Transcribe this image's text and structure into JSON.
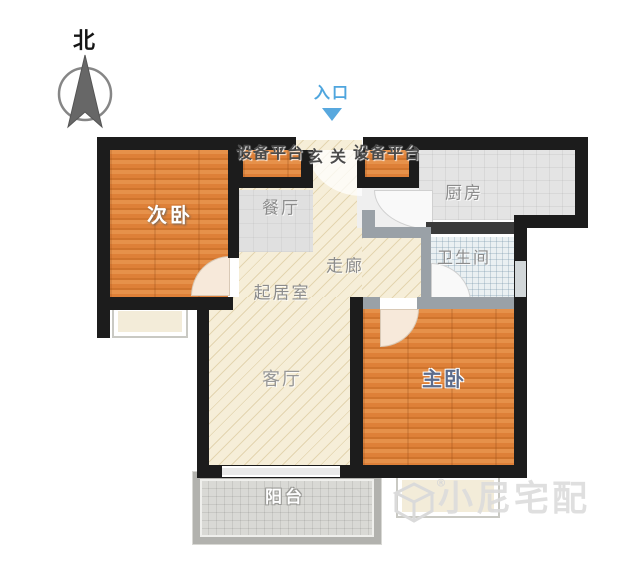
{
  "compass": {
    "north_label": "北"
  },
  "entrance": {
    "label": "入口"
  },
  "rooms": {
    "equipment_platform_left": "设备平台",
    "entry_hall": "玄关",
    "equipment_platform_right": "设备平台",
    "secondary_bedroom": "次卧",
    "dining_room": "餐厅",
    "kitchen": "厨房",
    "corridor": "走廊",
    "bathroom": "卫生间",
    "living_area": "起居室",
    "living_room": "客厅",
    "master_bedroom": "主卧",
    "balcony": "阳台"
  },
  "watermark": {
    "brand": "小尼宅配",
    "registered_mark": "®"
  },
  "colors": {
    "wall": "#1c1c1c",
    "interior_wall_gray": "#9aa1a7",
    "wood_floor": "#de8038",
    "cream_floor": "#f6eed8",
    "tile_floor": "#e4e4e4",
    "bath_tile": "#eaf0f2",
    "entrance_accent": "#4fa6de",
    "master_label": "#5d6c8c",
    "watermark_gray": "#dcdcdc"
  }
}
